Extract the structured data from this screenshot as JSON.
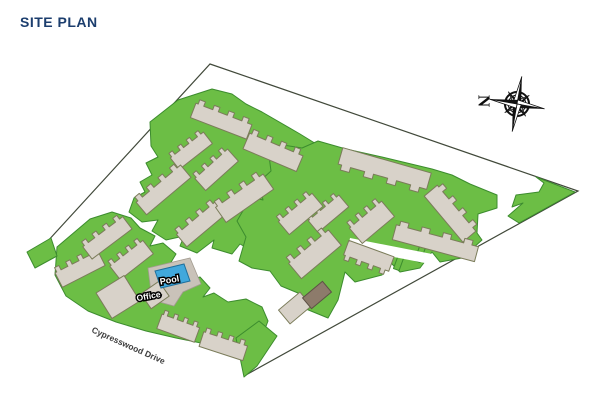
{
  "title": "SITE PLAN",
  "map": {
    "labels": {
      "pool": "Pool",
      "office": "Office",
      "street": "Cypresswood Drive"
    },
    "compass": {
      "north_letter": "N"
    },
    "colors": {
      "title-navy": "#1c3e6e",
      "lawn-green": "#6cbe45",
      "lawn-outline": "#3c8c2e",
      "building-tan": "#d8d2c9",
      "building-outline": "#7b7c5a",
      "brown-building": "#8d7b6b",
      "pool-blue": "#41a8dc",
      "pool-outline": "#1e6f9c",
      "pad-grey": "#c9c2b9",
      "boundary-line": "#41493a",
      "background": "#ffffff"
    }
  }
}
